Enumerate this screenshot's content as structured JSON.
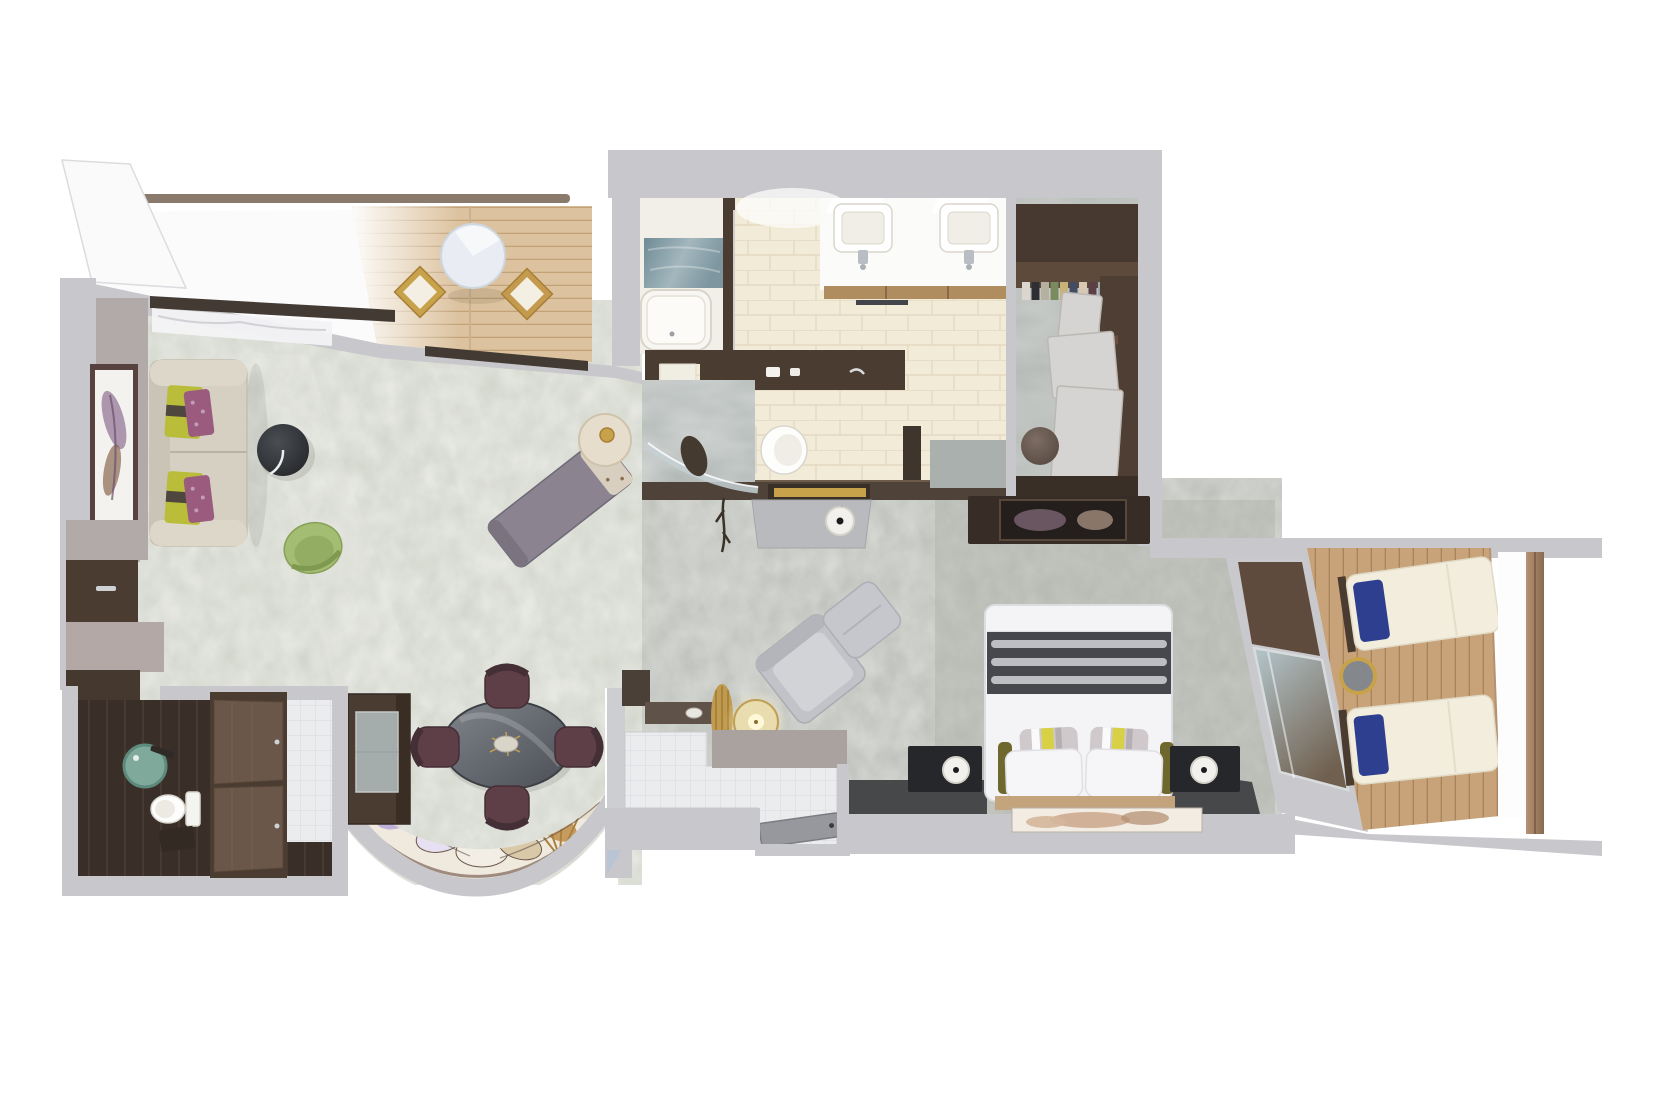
{
  "scene": {
    "kind": "floor-plan",
    "render_style": "top-down 3D cutaway rendering",
    "subject": "suite floor plan with verandas",
    "background": "#ffffff"
  },
  "palette": {
    "page": "#ffffff",
    "wall": "#c8c8cc",
    "wallShade": "#b2aaa8",
    "carpetLiving": "#cdd1c6",
    "carpetCorridor": "#b8bbb5",
    "carpetDark": "#46484a",
    "deckFwd": "#dcc29e",
    "deckFwdLine": "#c1a279",
    "deckAft": "#c8a379",
    "deckAftLine": "#a6835c",
    "tileCream": "#f2ebd8",
    "tileCreamLine": "#e2d7be",
    "tileWhite": "#eaecee",
    "tileWhiteLine": "#d7d9dc",
    "darkWood": "#4a3c31",
    "midWood": "#6b5749",
    "floorDark": "#3a2f28",
    "sofa": "#d6d0c3",
    "chartreuse": "#b9bd3a",
    "plum": "#9a5b7f",
    "chaise": "#8b8490",
    "ottoman": "#2f3237",
    "chairGreen": "#a3bd72",
    "diningChair": "#5e3f48",
    "tableDark": "#5c6066",
    "rugBase": "#efe9de",
    "bedWhite": "#f4f4f6",
    "runner": "#46484d",
    "runnerStripe": "#c9cbd0",
    "olive": "#6e682f",
    "navy": "#2e3f8f",
    "lounger": "#f2eddd",
    "gold": "#c8a24a",
    "railing": "#9b7d63",
    "marbleBlue": "#7d96a0",
    "glassTeal": "#7fa99b",
    "vanity": "#fbfbf9",
    "woodDrawer": "#b08d5f",
    "consoleGrey": "#b9babe",
    "doorGray": "#97989d",
    "mirrorDark": "#372d26",
    "headboard": "#c3a47c",
    "artPanel": "#f2ece2",
    "nightstand": "#26272b",
    "grayChair": "#c2c3c8",
    "lampDisc": "#f2f1ed"
  },
  "rooms": [
    {
      "id": "forward-veranda",
      "items": [
        "teak-decking",
        "railing",
        "round-table",
        "deck-chair",
        "deck-chair"
      ]
    },
    {
      "id": "living-room",
      "items": [
        "sofa",
        "chartreuse-pillows",
        "plum-pillows",
        "framed-artwork",
        "round-coffee-table",
        "green-swivel-chair",
        "chaise-lounge",
        "side-table-with-gold-lamp",
        "wall-console"
      ]
    },
    {
      "id": "dining-area",
      "items": [
        "oval-dining-table",
        "dining-chair",
        "dining-chair",
        "dining-chair",
        "dining-chair",
        "fan-pattern-rug",
        "bar-cabinet"
      ]
    },
    {
      "id": "entry-foyer",
      "items": [
        "entrance-door",
        "console-with-lamp",
        "gold-vase",
        "tiled-floor"
      ]
    },
    {
      "id": "bathroom",
      "items": [
        "double-vanity",
        "twin-sinks",
        "bathtub",
        "marble-shower",
        "tiled-floor"
      ]
    },
    {
      "id": "water-closet",
      "items": [
        "toilet",
        "dark-vanity-counter"
      ]
    },
    {
      "id": "walk-in-closet",
      "items": [
        "wardrobe",
        "open-doors",
        "clothes-rail",
        "pouf"
      ]
    },
    {
      "id": "corridor",
      "items": [
        "writing-desk",
        "table-lamp",
        "decor-branch"
      ]
    },
    {
      "id": "bedroom",
      "items": [
        "king-bed",
        "striped-runner",
        "pillows",
        "nightstand",
        "nightstand",
        "table-lamp",
        "table-lamp",
        "tv-console-mirror",
        "lounge-chair",
        "ottoman",
        "headboard-art",
        "veranda-window"
      ]
    },
    {
      "id": "aft-veranda",
      "items": [
        "sun-lounger",
        "sun-lounger",
        "navy-pillows",
        "round-side-table",
        "teak-decking",
        "railing"
      ]
    },
    {
      "id": "powder-room",
      "items": [
        "glass-basin",
        "toilet",
        "dark-wood-floor"
      ]
    },
    {
      "id": "wardrobe-closet",
      "items": [
        "double-door-wardrobe"
      ]
    }
  ]
}
